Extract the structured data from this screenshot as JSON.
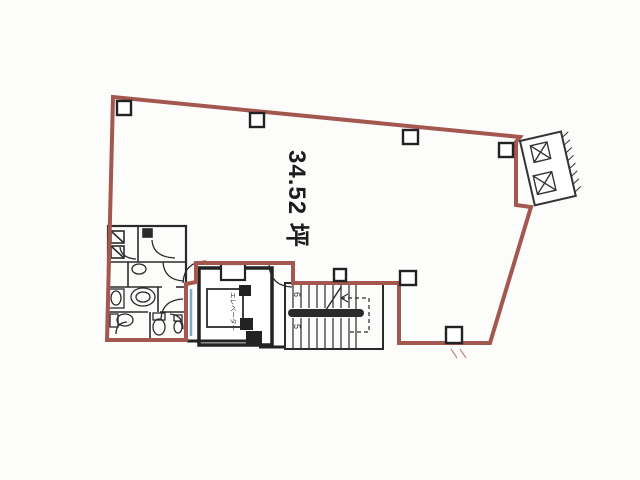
{
  "floor_plan": {
    "area_label": "34.52 坪",
    "elevator_label": "エレベーター",
    "stair_upper_label": "6",
    "stair_lower_label": "5",
    "colors": {
      "boundary": "#a3574f",
      "interior_lines": "#2b2b2b",
      "entrance_door": "#7fa8c8",
      "paper": "#fcfcfb"
    }
  }
}
